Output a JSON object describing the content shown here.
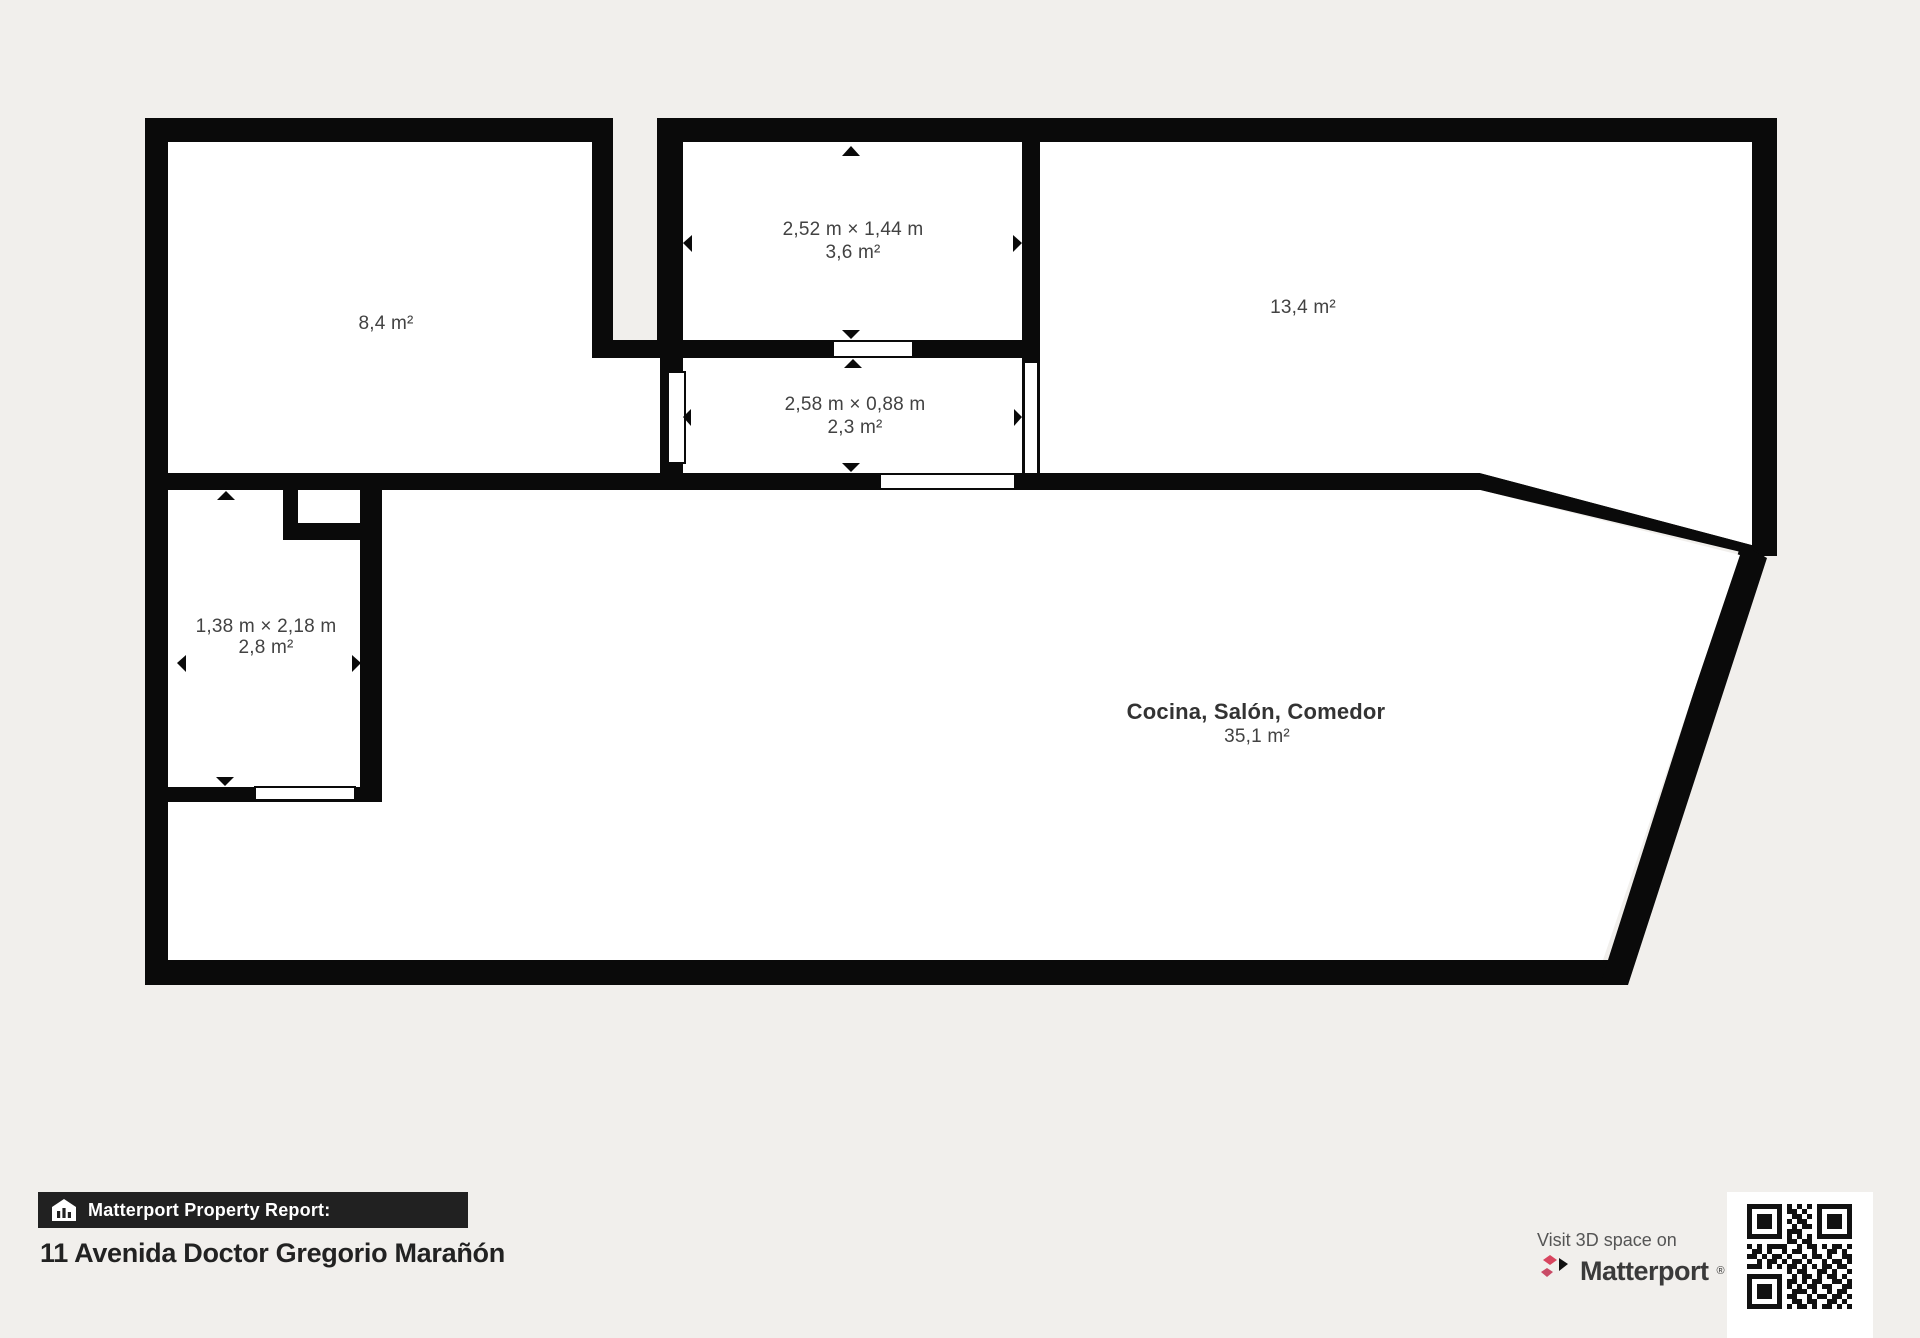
{
  "plan": {
    "rooms": {
      "room_84": {
        "area": "8,4 m²"
      },
      "room_36": {
        "dims": "2,52 m × 1,44 m",
        "area": "3,6 m²"
      },
      "room_23": {
        "dims": "2,58 m × 0,88 m",
        "area": "2,3 m²"
      },
      "room_134": {
        "area": "13,4 m²"
      },
      "room_28": {
        "dims": "1,38 m × 2,18 m",
        "area": "2,8 m²"
      },
      "room_cocina": {
        "name": "Cocina, Salón, Comedor",
        "area": "35,1 m²"
      }
    }
  },
  "footer": {
    "report_label": "Matterport Property Report:",
    "address": "11 Avenida Doctor Gregorio Marañón",
    "visit_text": "Visit 3D space on",
    "brand_name": "Matterport",
    "brand_mark": "®"
  },
  "icons": {
    "house_icon": "house-with-bar-chart",
    "matterport_logo": "matterport-m-mark",
    "qr_code": "qr-code"
  },
  "colors": {
    "background": "#f1efec",
    "walls": "#0a0a0a",
    "floor": "#ffffff",
    "footer_bar": "#212121",
    "brand_red": "#d8455f",
    "label_text": "#424242"
  },
  "qr_rows": [
    "111111101010101111111",
    "100000101101001000001",
    "101110100110101011101",
    "101110101011001011101",
    "101110100101101011101",
    "100000101110001000001",
    "111111101010101111111",
    "000000001101100000000",
    "101011110010110101101",
    "011010010110010011010",
    "110101101001011010011",
    "001011010110100101101",
    "111010101101010110110",
    "000000001011001101001",
    "111111100101101011010",
    "100000101101011001101",
    "101110101010110110011",
    "101110100111010010110",
    "101110101100101101101",
    "100000100110110011010",
    "111111101011010110101"
  ]
}
